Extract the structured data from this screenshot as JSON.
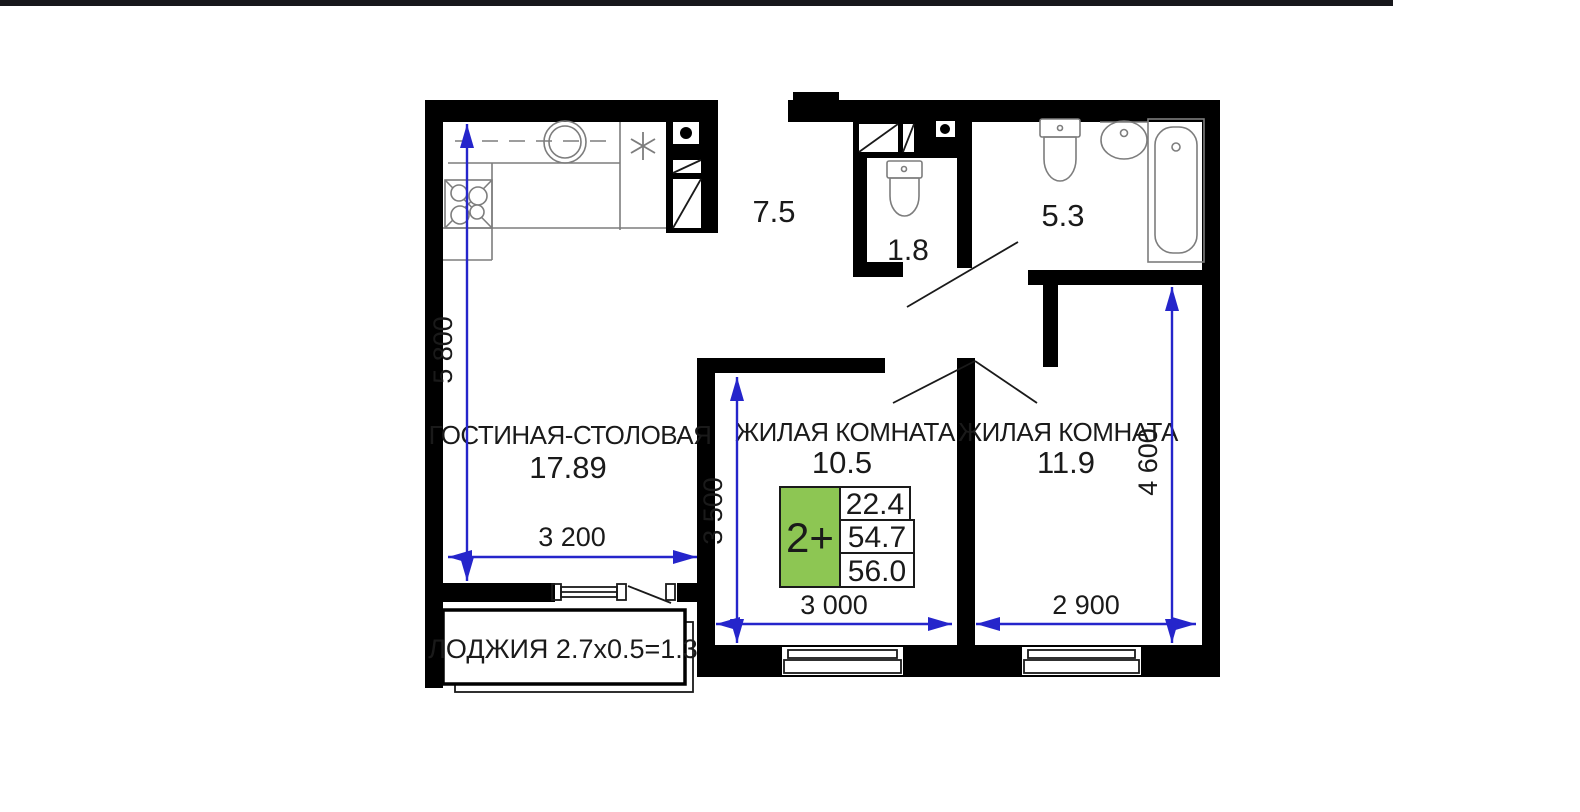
{
  "canvas": {
    "width": 1580,
    "height": 812
  },
  "colors": {
    "canvas_bg": "#ffffff",
    "topbar_dark": "#17171b",
    "wall": "#000000",
    "dim_blue": "#2525cb",
    "label_text": "#1a1a1a",
    "fixture_gray": "#7d7d7d",
    "accent_green": "#8dc653"
  },
  "rooms": {
    "living_dining": {
      "name": "ГОСТИНАЯ-СТОЛОВАЯ",
      "area": "17.89"
    },
    "bedroom1": {
      "name": "ЖИЛАЯ КОМНАТА",
      "area": "10.5"
    },
    "bedroom2": {
      "name": "ЖИЛАЯ КОМНАТА",
      "area": "11.9"
    },
    "hall": {
      "area": "7.5"
    },
    "wc": {
      "area": "1.8"
    },
    "bathroom": {
      "area": "5.3"
    },
    "loggia": {
      "label": "ЛОДЖИЯ 2.7x0.5=1.3"
    }
  },
  "info_card": {
    "type_label": "2+",
    "values": [
      "22.4",
      "54.7",
      "56.0"
    ]
  },
  "dimensions": {
    "kitchen_height": "5 800",
    "living_width": "3 200",
    "bedroom1_height": "3 500",
    "bedroom1_width": "3 000",
    "bedroom2_width": "2 900",
    "bedroom2_height": "4 600"
  }
}
